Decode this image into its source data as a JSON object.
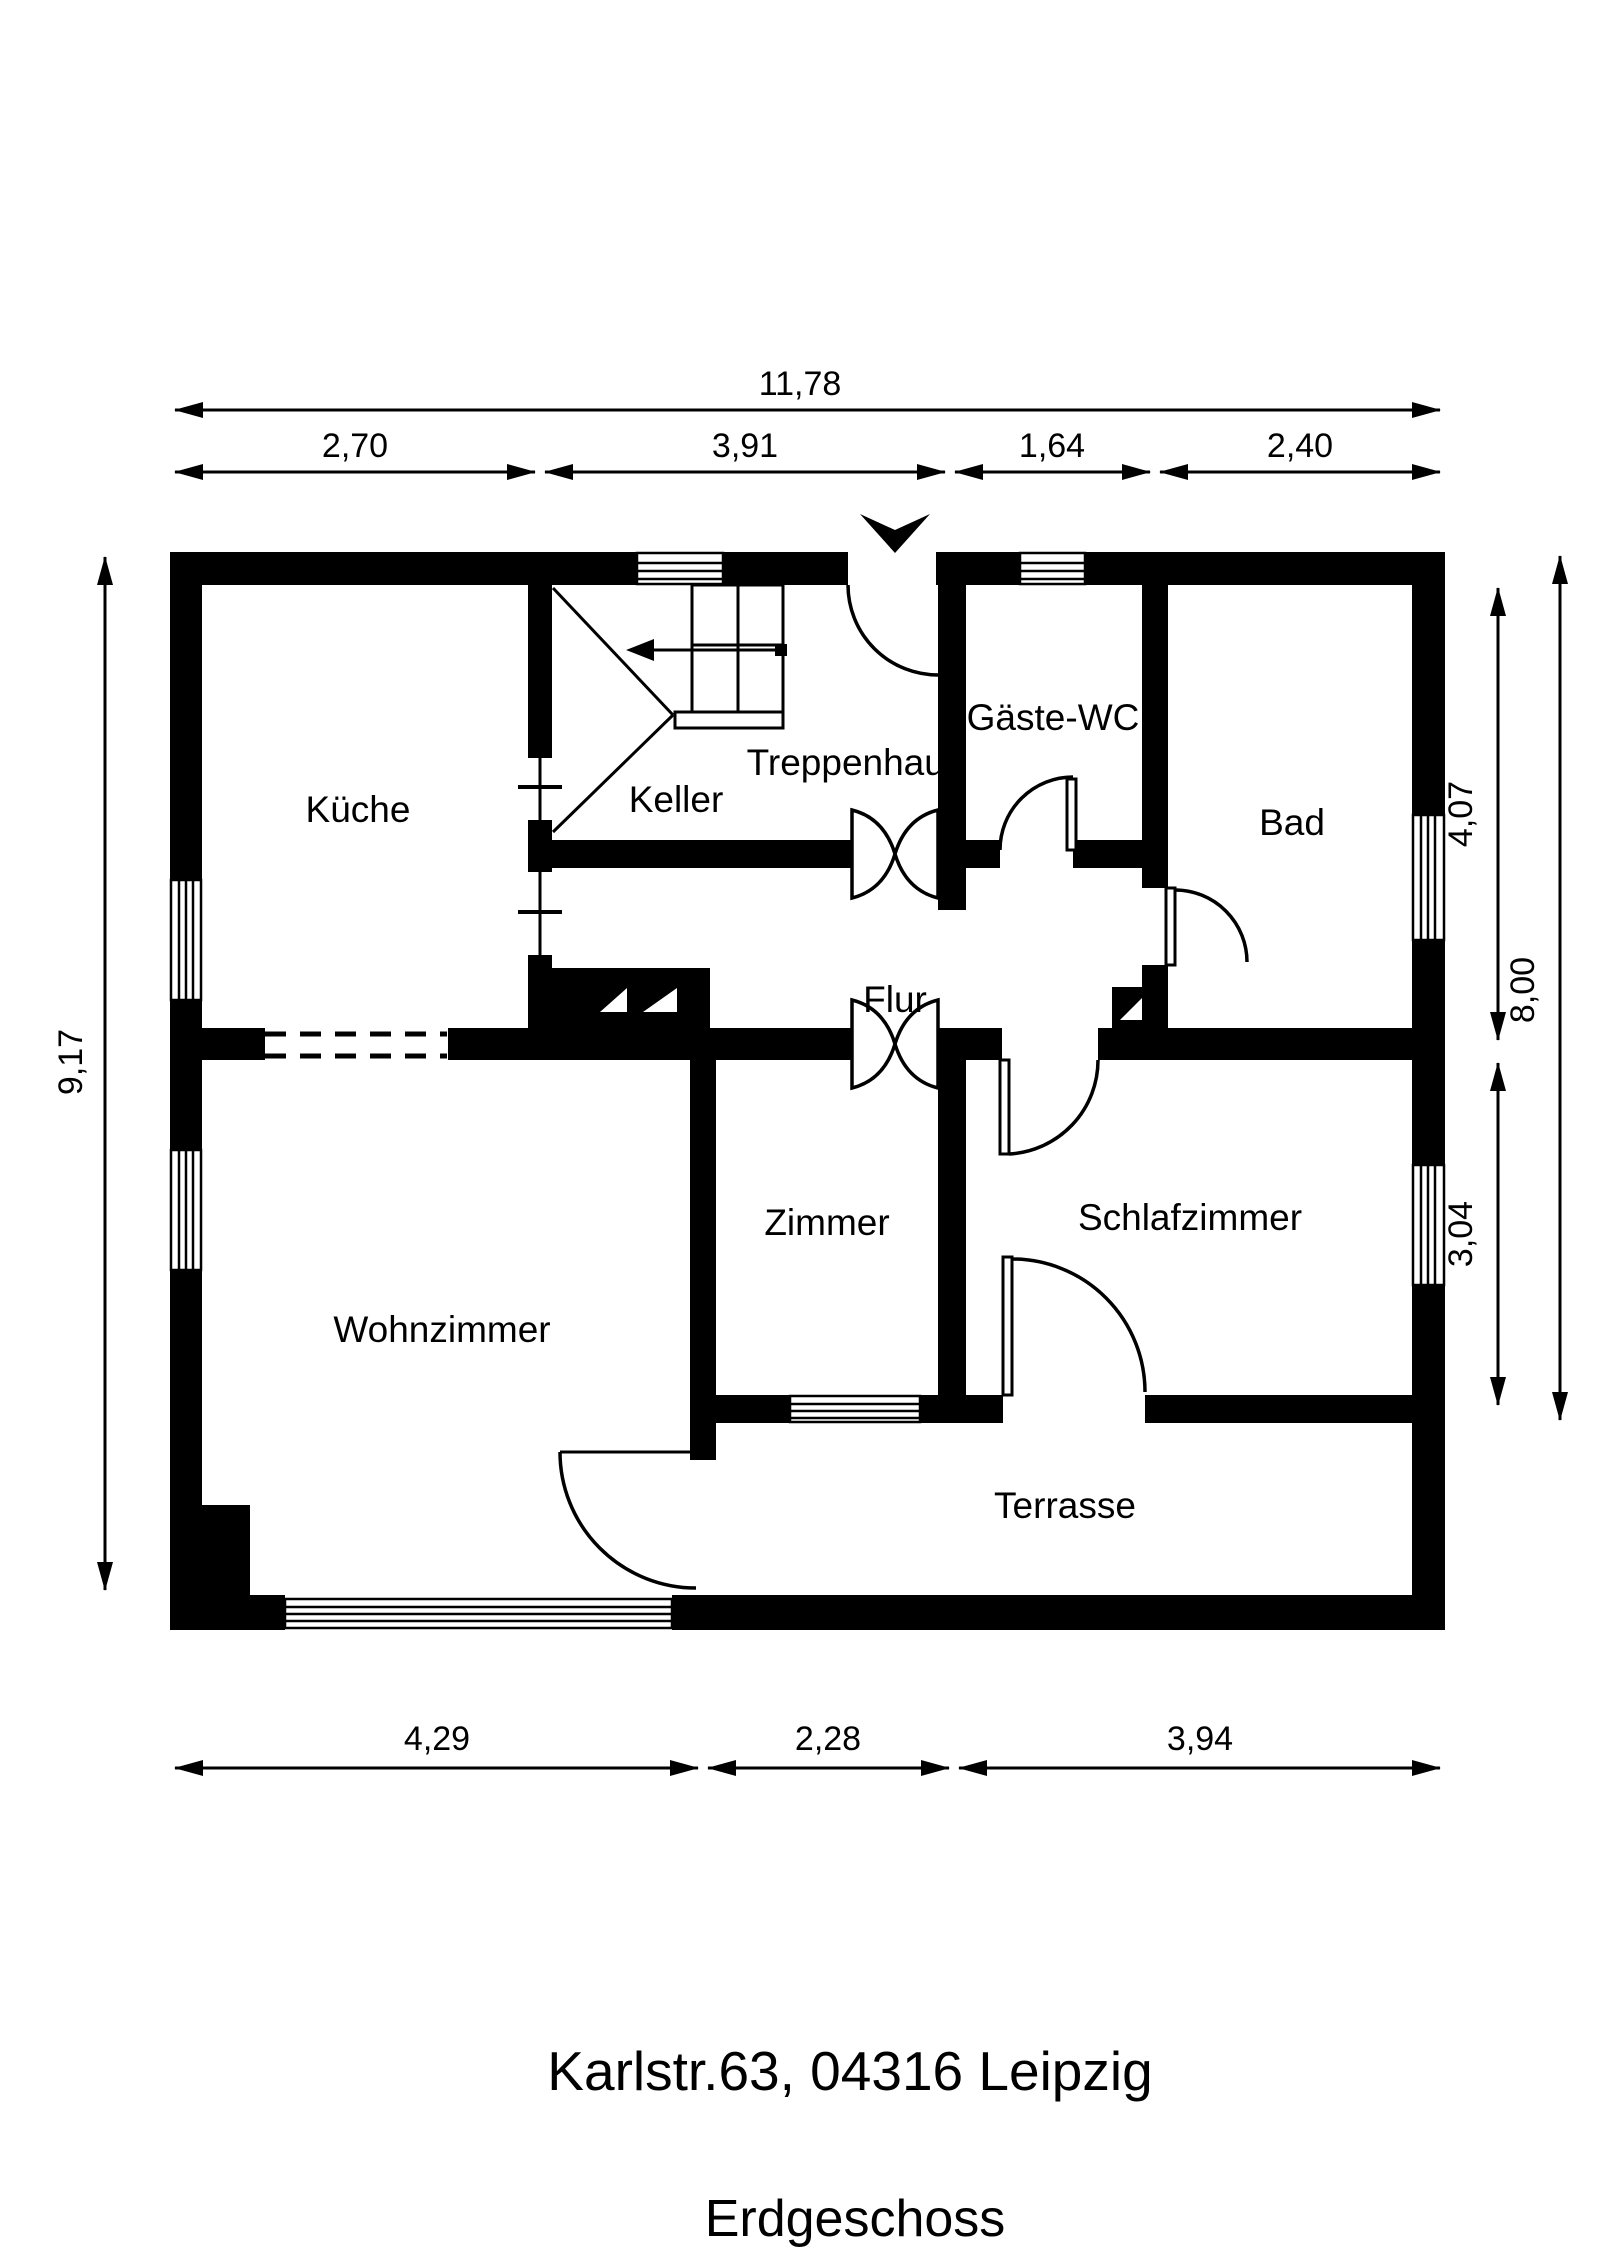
{
  "title": {
    "address": "Karlstr.63, 04316 Leipzig",
    "floor": "Erdgeschoss"
  },
  "rooms": {
    "kueche": "Küche",
    "keller": "Keller",
    "treppenhaus": "Treppenhaus",
    "gaeste_wc": "Gäste-WC",
    "bad": "Bad",
    "flur": "Flur",
    "zimmer": "Zimmer",
    "schlafzimmer": "Schlafzimmer",
    "wohnzimmer": "Wohnzimmer",
    "terrasse": "Terrasse"
  },
  "dimensions": {
    "top_total": "11,78",
    "top_segments": [
      "2,70",
      "3,91",
      "1,64",
      "2,40"
    ],
    "left_total": "9,17",
    "right_inner": [
      "4,07",
      "3,04"
    ],
    "right_total": "8,00",
    "bottom_segments": [
      "4,29",
      "2,28",
      "3,94"
    ]
  },
  "icons": {
    "entrance": "entrance-arrow"
  },
  "colors": {
    "ink": "#000000",
    "paper": "#ffffff"
  }
}
